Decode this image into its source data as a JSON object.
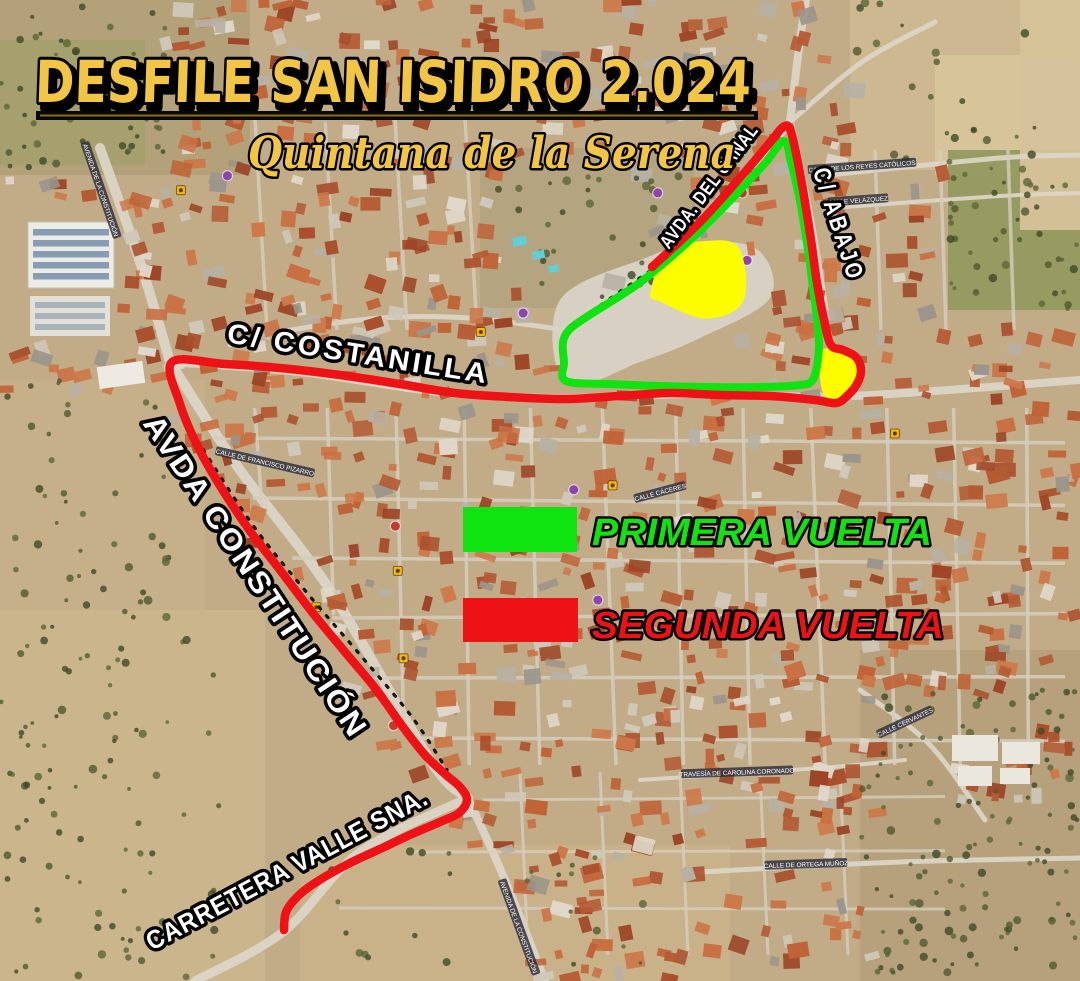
{
  "poster": {
    "title": "DESFILE SAN ISIDRO 2.024",
    "subtitle": "Quintana de la Serena",
    "title_color": "#f2c644",
    "outline_color": "#000000"
  },
  "legend": {
    "items": [
      {
        "id": "primera",
        "label": "PRIMERA VUELTA",
        "color": "#10e410"
      },
      {
        "id": "segunda",
        "label": "SEGUNDA VUELTA",
        "color": "#ee1216"
      }
    ]
  },
  "street_labels": [
    {
      "id": "costanilla",
      "text": "C/ COSTANILLA",
      "x": 357,
      "y": 363,
      "rot": 9,
      "size": 28,
      "length": 265,
      "ls": 3
    },
    {
      "id": "constitucion",
      "text": "AVDA CONSTITUCIÓN",
      "x": 247,
      "y": 582,
      "rot": 56.5,
      "size": 30,
      "length": 380,
      "ls": 2
    },
    {
      "id": "carretera",
      "text": "CARRETERA VALLE SNA.",
      "x": 291,
      "y": 877,
      "rot": -28,
      "size": 26,
      "length": 315,
      "ls": 1
    },
    {
      "id": "canal",
      "text": "AVDA. DEL CANAL",
      "x": 714,
      "y": 190,
      "rot": -53,
      "size": 19,
      "length": 150,
      "ls": 1
    },
    {
      "id": "abajo",
      "text": "C/ ABAJO",
      "x": 831,
      "y": 227,
      "rot": 72,
      "size": 24,
      "length": 118,
      "ls": 4
    }
  ],
  "map_micro_labels": [
    {
      "text": "AVENIDA DE LA CONSTITUCIÓN",
      "x": 101,
      "y": 190,
      "rot": 71
    },
    {
      "text": "CALLE DE FRANCISCO PIZARRO",
      "x": 265,
      "y": 462,
      "rot": 13
    },
    {
      "text": "CALLE DE LOS REYES CATÓLICOS",
      "x": 862,
      "y": 166,
      "rot": -4
    },
    {
      "text": "CALLE VELÁZQUEZ",
      "x": 858,
      "y": 200,
      "rot": -4
    },
    {
      "text": "CALLE CÁCERES",
      "x": 660,
      "y": 492,
      "rot": -15
    },
    {
      "text": "TRAVESÍA DE CAROLINA CORONADO",
      "x": 737,
      "y": 772,
      "rot": -2
    },
    {
      "text": "CALLE DE ORTEGA MUÑOZ",
      "x": 806,
      "y": 864,
      "rot": -2
    },
    {
      "text": "CALLE CERVANTES",
      "x": 905,
      "y": 722,
      "rot": -25
    },
    {
      "text": "AVENIDA DE LA CONSTITUCIÓN",
      "x": 519,
      "y": 927,
      "rot": 70
    }
  ],
  "routes": {
    "primera_vuelta": {
      "name": "PRIMERA VUELTA",
      "color": "#10e410",
      "width": 8,
      "closed": true,
      "points": [
        [
          784,
          141
        ],
        [
          766,
          162
        ],
        [
          742,
          188
        ],
        [
          716,
          215
        ],
        [
          690,
          240
        ],
        [
          664,
          263
        ],
        [
          638,
          284
        ],
        [
          612,
          301
        ],
        [
          588,
          316
        ],
        [
          570,
          329
        ],
        [
          563,
          342
        ],
        [
          564,
          362
        ],
        [
          566,
          381
        ],
        [
          610,
          384
        ],
        [
          660,
          386
        ],
        [
          710,
          387
        ],
        [
          762,
          387
        ],
        [
          800,
          385
        ],
        [
          812,
          381
        ],
        [
          817,
          366
        ],
        [
          819,
          344
        ],
        [
          817,
          317
        ],
        [
          813,
          288
        ],
        [
          809,
          257
        ],
        [
          804,
          224
        ],
        [
          798,
          191
        ],
        [
          791,
          162
        ]
      ]
    },
    "segunda_vuelta": {
      "name": "SEGUNDA VUELTA",
      "color": "#ee1216",
      "width": 8.5,
      "closed": false,
      "points": [
        [
          652,
          267
        ],
        [
          700,
          222
        ],
        [
          745,
          172
        ],
        [
          772,
          140
        ],
        [
          783,
          127
        ],
        [
          790,
          129
        ],
        [
          797,
          158
        ],
        [
          804,
          196
        ],
        [
          811,
          240
        ],
        [
          817,
          283
        ],
        [
          824,
          320
        ],
        [
          831,
          345
        ],
        [
          843,
          350
        ],
        [
          856,
          357
        ],
        [
          861,
          370
        ],
        [
          857,
          384
        ],
        [
          847,
          396
        ],
        [
          836,
          403
        ],
        [
          815,
          400
        ],
        [
          770,
          396
        ],
        [
          720,
          395
        ],
        [
          670,
          393
        ],
        [
          620,
          396
        ],
        [
          565,
          399
        ],
        [
          510,
          397
        ],
        [
          455,
          393
        ],
        [
          400,
          384
        ],
        [
          340,
          375
        ],
        [
          280,
          368
        ],
        [
          225,
          364
        ],
        [
          172,
          362
        ],
        [
          180,
          404
        ],
        [
          198,
          447
        ],
        [
          222,
          489
        ],
        [
          250,
          531
        ],
        [
          280,
          570
        ],
        [
          312,
          612
        ],
        [
          345,
          652
        ],
        [
          375,
          688
        ],
        [
          403,
          727
        ],
        [
          425,
          755
        ],
        [
          445,
          774
        ],
        [
          460,
          787
        ],
        [
          467,
          800
        ],
        [
          459,
          813
        ],
        [
          440,
          822
        ],
        [
          412,
          834
        ],
        [
          380,
          849
        ],
        [
          348,
          864
        ],
        [
          318,
          881
        ],
        [
          298,
          896
        ],
        [
          286,
          912
        ],
        [
          284,
          930
        ]
      ]
    }
  },
  "highlight_areas": [
    {
      "id": "plaza-triangle",
      "color": "#fdfd00",
      "points": [
        [
          652,
          292
        ],
        [
          668,
          252
        ],
        [
          700,
          243
        ],
        [
          737,
          248
        ],
        [
          742,
          300
        ],
        [
          706,
          317
        ],
        [
          660,
          300
        ]
      ]
    },
    {
      "id": "plaza-small",
      "color": "#fdfd00",
      "points": [
        [
          823,
          352
        ],
        [
          847,
          354
        ],
        [
          860,
          362
        ],
        [
          857,
          386
        ],
        [
          840,
          399
        ],
        [
          824,
          391
        ]
      ]
    }
  ],
  "dashed_guides": [
    {
      "id": "plaza-edge",
      "points": [
        [
          650,
          271
        ],
        [
          608,
          300
        ],
        [
          567,
          328
        ]
      ]
    },
    {
      "id": "constitucion-side",
      "points": [
        [
          197,
          440
        ],
        [
          252,
          524
        ],
        [
          308,
          594
        ],
        [
          362,
          657
        ],
        [
          412,
          717
        ],
        [
          447,
          770
        ]
      ]
    }
  ]
}
